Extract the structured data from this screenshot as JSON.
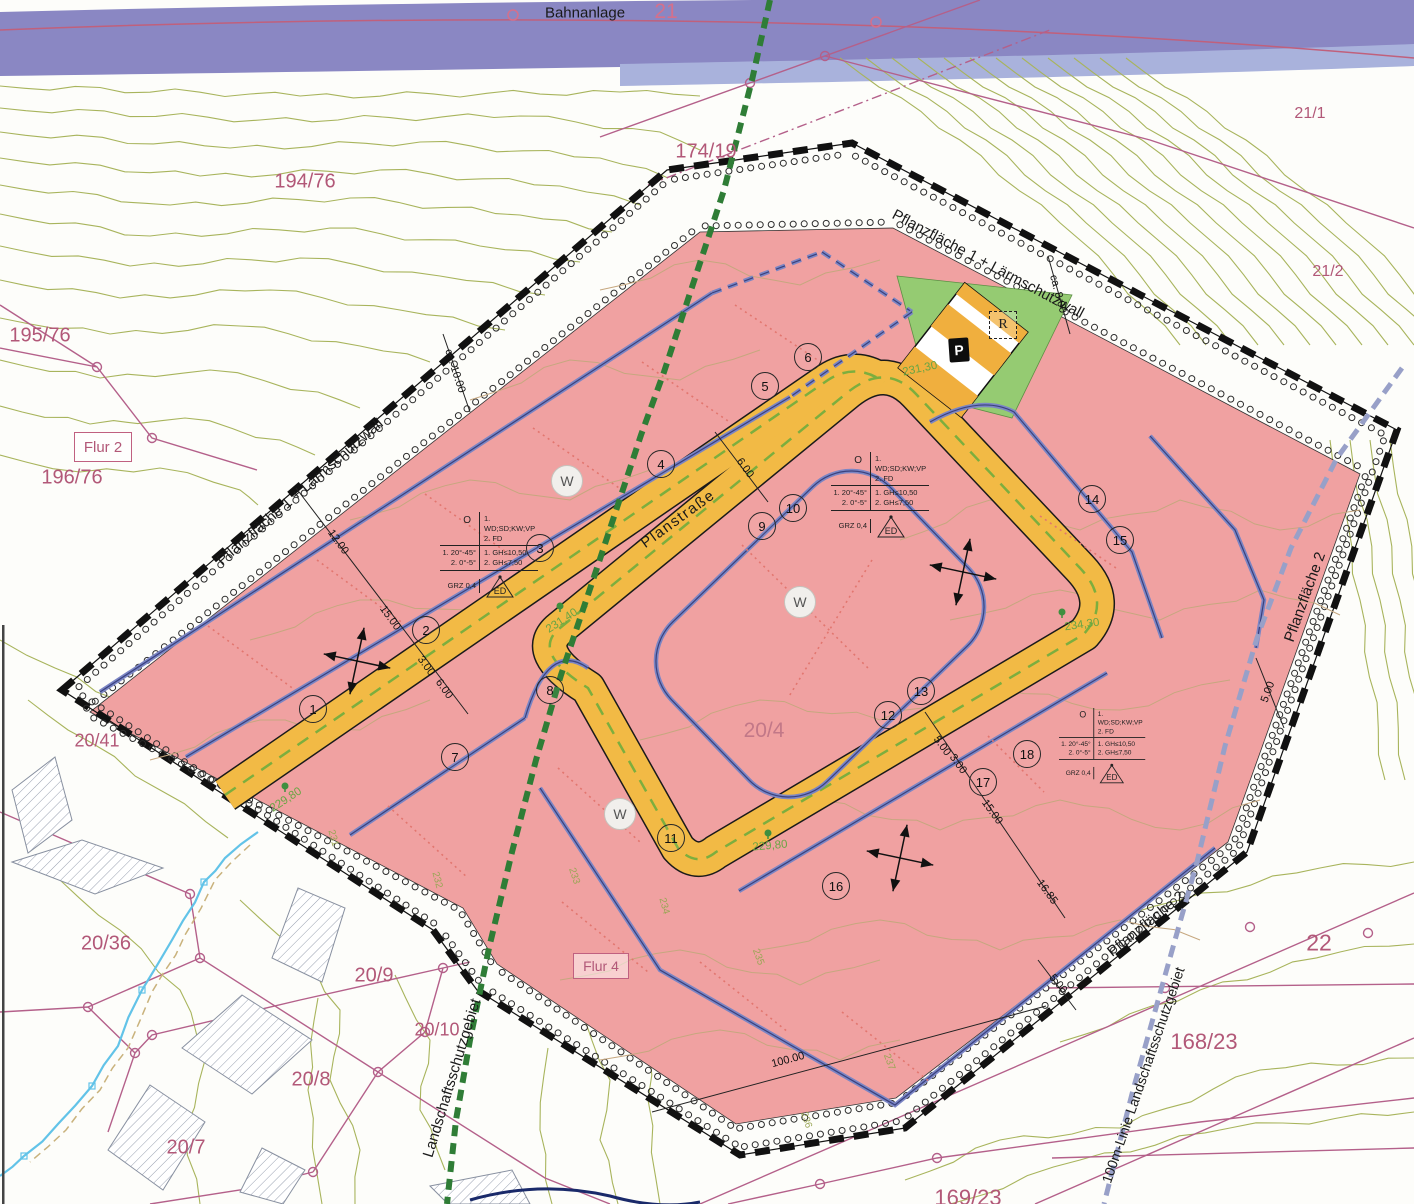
{
  "band": {
    "label": "Bahnanlage",
    "parcel": "21"
  },
  "parcels": {
    "p194": "194/76",
    "p195": "195/76",
    "p196": "196/76",
    "p174": "174/19",
    "p21_1": "21/1",
    "p21_2": "21/2",
    "p20_41": "20/41",
    "p20_36": "20/36",
    "p20_9": "20/9",
    "p20_10": "20/10",
    "p20_8": "20/8",
    "p20_7": "20/7",
    "p20_4": "20/4",
    "p168": "168/23",
    "p22": "22",
    "p169": "169/23"
  },
  "flur": {
    "flur2": "Flur 2",
    "flur4": "Flur 4"
  },
  "annotations": {
    "pflanz1a": "Pflanzfläche 1 + Lärmschutzwall",
    "pflanz1b": "Pflanzfläche 1 + Lärmschutzwall",
    "pflanz2a": "Pflanzfläche 2",
    "pflanz2b": "Pflanzfläche 2",
    "lsg": "Landschaftsschutzgebiet",
    "lsg100": "100m-Linie Landschaftsschutzgebiet",
    "planstrasse": "Planstraße"
  },
  "lots": [
    "1",
    "2",
    "3",
    "4",
    "5",
    "6",
    "7",
    "8",
    "9",
    "10",
    "11",
    "12",
    "13",
    "14",
    "15",
    "16",
    "17",
    "18"
  ],
  "w_label": "W",
  "parking_label": "P",
  "r_label": "R",
  "spec": {
    "o": "O",
    "roof1": "1. WD;SD;KW;VP",
    "roof2": "2. FD",
    "slope1": "1. 20°-45°",
    "slope2": "2. 0°-5°",
    "gh1": "1. GH≤10,50",
    "gh2": "2. GH≤7,50",
    "grz": "GRZ 0,4",
    "ed": "ED"
  },
  "dimensions": {
    "d12": "12.00",
    "d15a": "15.00",
    "d3a": "3.00",
    "d6a": "6.00",
    "d6b": "6.00",
    "d5a": "5.00",
    "d3b": "3.00",
    "d15b": "15.00",
    "d1685": "16.85",
    "d5b": "5.00",
    "d5c": "5.00",
    "dca10": "ca. 10.00",
    "dca8": "ca. 8.00",
    "d100": "100.00"
  },
  "elevations": {
    "e1": "229,80",
    "e2": "231,40",
    "e3": "231,30",
    "e4": "234,30",
    "e5": "229,80"
  },
  "contours": [
    "231",
    "232",
    "233",
    "234",
    "235",
    "236",
    "237"
  ],
  "colors": {
    "site_pink": "#f0a1a1",
    "road_yellow": "#f2ba45",
    "green_area": "#95cb72",
    "rail_band": "#8a87c3",
    "boundary_black": "#111111",
    "baugrenze_blue": "#6e79bd",
    "cadastral_magenta": "#b4608a",
    "lsg_green": "#2f7d36",
    "dim_100m_line": "#98a0c8"
  }
}
